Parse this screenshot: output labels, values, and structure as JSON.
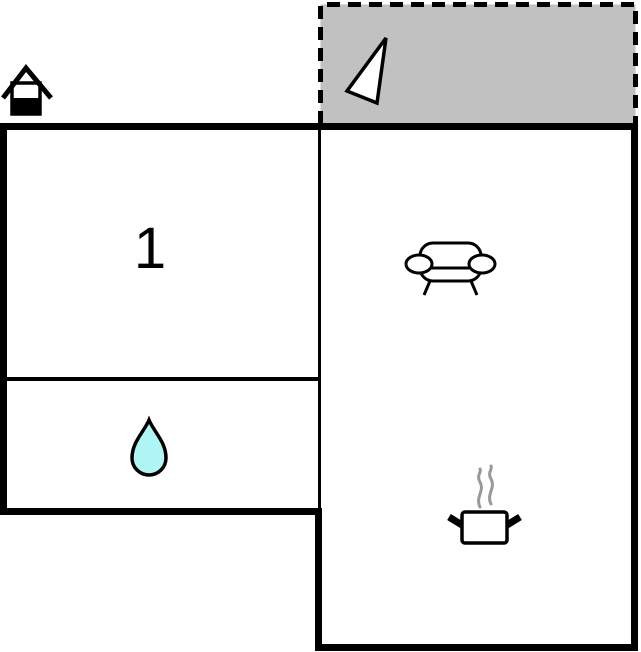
{
  "plan": {
    "type": "floor-plan",
    "rooms": {
      "bedroom": {
        "label": "1",
        "icon": null
      },
      "bathroom": {
        "label": "",
        "icon": "water-drop"
      },
      "living_kitchen": {
        "label": "",
        "icons": [
          "sofa",
          "cooking-pot"
        ]
      },
      "terrace": {
        "label": "",
        "icon": "north-arrow",
        "border_style": "dashed"
      }
    },
    "icons": {
      "entrance": "house-icon",
      "north_arrow": "north-arrow-icon",
      "sofa": "sofa-icon",
      "water": "water-drop-icon",
      "cooking": "cooking-pot-icon"
    },
    "colors": {
      "background": "#ffffff",
      "wall": "#000000",
      "terrace_fill": "#c1c1c1",
      "water_drop_fill": "#b0f6f6",
      "steam": "#999999",
      "icon_fill": "#ffffff",
      "house_icon_fill": "#000000"
    }
  }
}
